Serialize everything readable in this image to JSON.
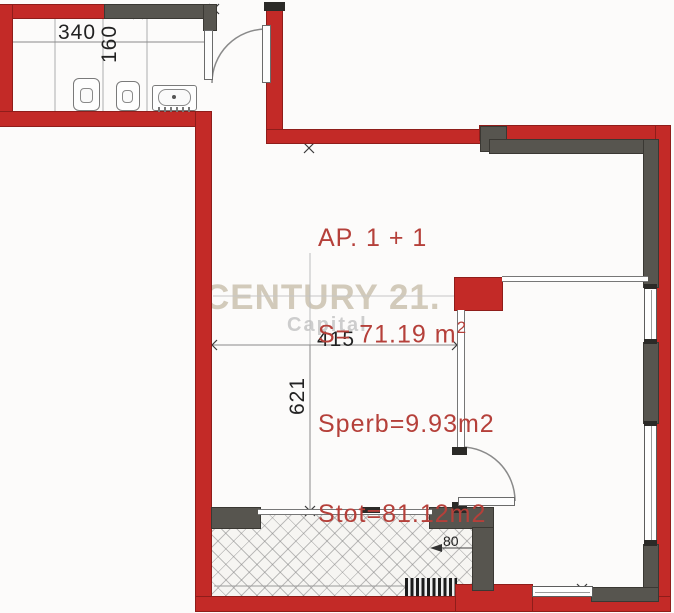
{
  "plan": {
    "type": "apartment-floor-plan",
    "labels": {
      "unit": "AP. 1 + 1",
      "area_total": "S= 71.19 m",
      "area_total_sup": "2",
      "area_sperb": "Sperb=9.93m2",
      "area_stot": "Stot=81.12m2"
    },
    "dimensions": {
      "bath_width": "340",
      "bath_depth": "160",
      "room_width": "415",
      "room_height": "621",
      "balcony_depth": "80"
    },
    "watermark": {
      "brand": "CENTURY 21.",
      "sub": "Capital"
    }
  },
  "colors": {
    "wall_red": "#c32a27",
    "wall_gray": "#57554f",
    "text_red": "#b5403a",
    "dim_text": "#222222",
    "watermark_brand": "#cbc2b0",
    "watermark_sub": "#cdcdcd"
  }
}
